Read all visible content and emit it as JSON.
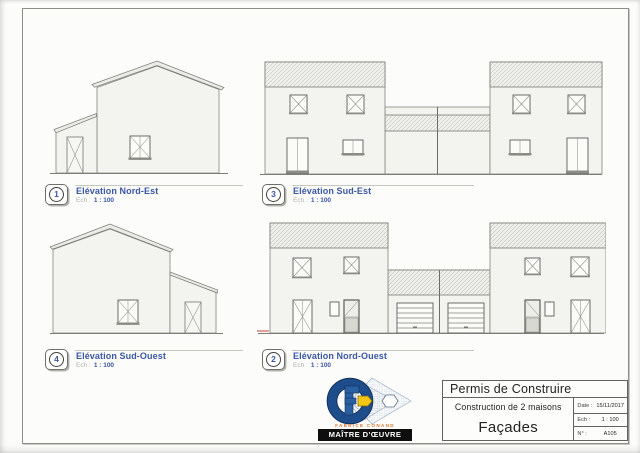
{
  "page": {
    "labels": [
      {
        "num": "1",
        "title": "Elévation Nord-Est",
        "scale_label": "Ech :",
        "scale_value": "1 : 100"
      },
      {
        "num": "3",
        "title": "Elévation Sud-Est",
        "scale_label": "Ech :",
        "scale_value": "1 : 100"
      },
      {
        "num": "4",
        "title": "Elévation Sud-Ouest",
        "scale_label": "Ech :",
        "scale_value": "1 : 100"
      },
      {
        "num": "2",
        "title": "Elévation Nord-Ouest",
        "scale_label": "Ech :",
        "scale_value": "1 : 100"
      }
    ],
    "title_block": {
      "title": "Permis de Construire",
      "project": "Construction de 2 maisons",
      "sheet": "Façades",
      "fields": [
        {
          "label": "Date :",
          "value": "15/11/2017"
        },
        {
          "label": "Ech :",
          "value": "1 : 100"
        },
        {
          "label": "N° :",
          "value": "A105"
        }
      ]
    },
    "logo": {
      "firm": "FABRICE CONAND",
      "banner": "MAÎTRE D'ŒUVRE"
    },
    "colors": {
      "label_blue": "#3a57a7",
      "paper": "#fcfcfa",
      "border_gray": "#8d8d88",
      "logo_blue": "#1e4d8b",
      "logo_yellow": "#f3c713",
      "logo_orange": "#e0742c",
      "banner_black": "#0e0e0e",
      "red_mark": "#c44438"
    }
  }
}
